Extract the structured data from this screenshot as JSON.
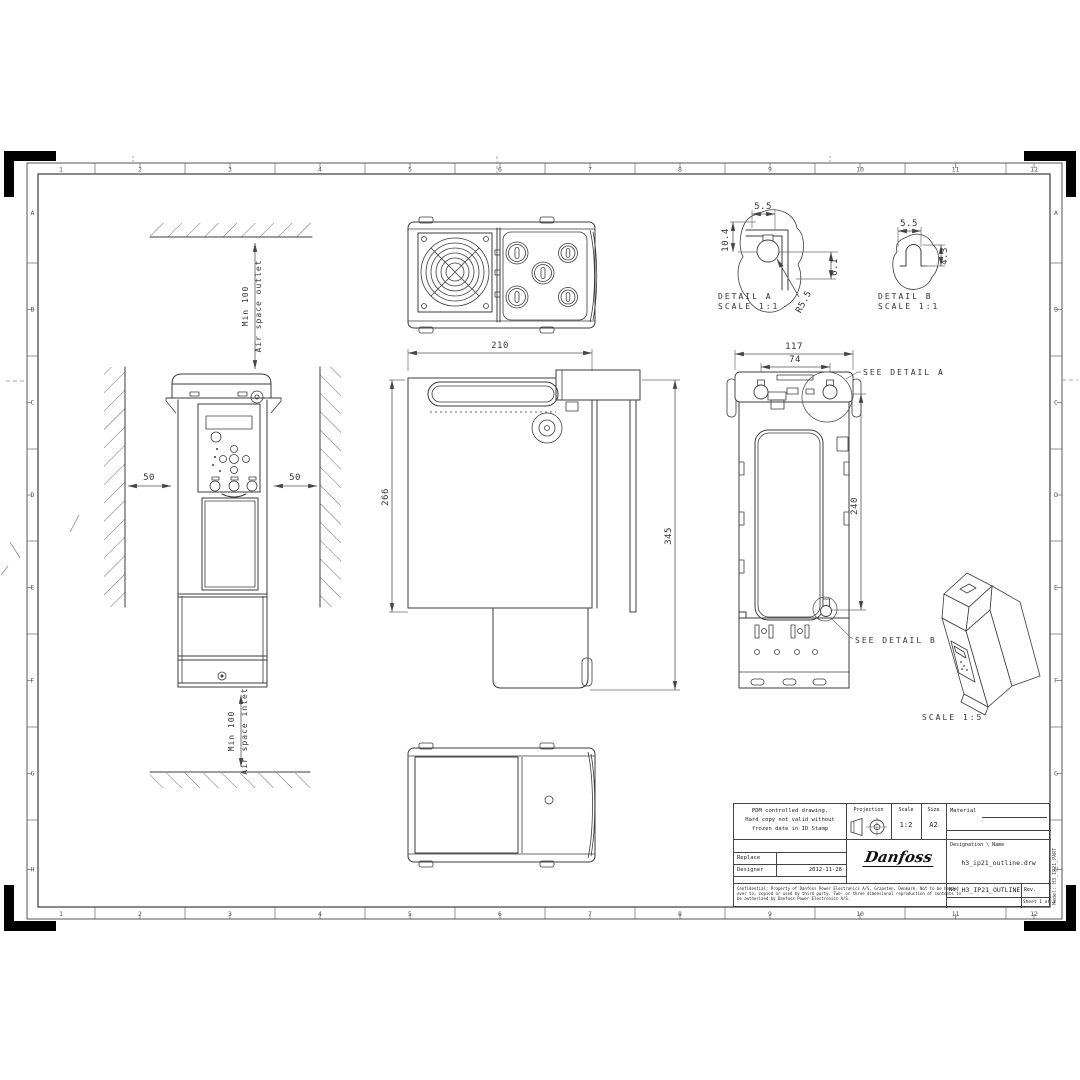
{
  "zones": {
    "columns": [
      "1",
      "2",
      "3",
      "4",
      "5",
      "6",
      "7",
      "8",
      "9",
      "10",
      "11",
      "12"
    ],
    "rows": [
      "A",
      "B",
      "C",
      "D",
      "E",
      "F",
      "G",
      "H"
    ]
  },
  "drawing": {
    "clearance": {
      "outlet_dim": "Min 100",
      "outlet_label": "Air space outlet",
      "inlet_dim": "Min 100",
      "inlet_label": "Air space inlet",
      "gap_left": "50",
      "gap_right": "50"
    },
    "side": {
      "depth": "210",
      "body_height": "266",
      "total_height": "345"
    },
    "rear": {
      "width": "117",
      "hole_pitch": "74",
      "hole_height": "240",
      "see_detail_a": "SEE DETAIL A",
      "see_detail_b": "SEE DETAIL B"
    },
    "detail_a": {
      "title": "DETAIL A",
      "scale": "SCALE 1:1",
      "dim_width": "5.5",
      "dim_height": "10.4",
      "dim_offset": "6.1",
      "dim_radius": "R5.5"
    },
    "detail_b": {
      "title": "DETAIL B",
      "scale": "SCALE 1:1",
      "dim_width": "5.5",
      "dim_height": "4.3"
    },
    "iso": {
      "scale_label": "SCALE 1:5"
    }
  },
  "title_block": {
    "pdm_note_1": "PDM controlled drawing.",
    "pdm_note_2": "Hard copy not valid without",
    "pdm_note_3": "frozen date in ID Stamp",
    "projection_label": "Projection",
    "scale_label": "Scale",
    "scale_value": "1:2",
    "size_label": "Size",
    "size_value": "A2",
    "material_label": "Material",
    "replace_label": "Replace",
    "designer_label": "Designer",
    "designer_date": "2012-11-28",
    "logo": "Danfoss",
    "designation_label": "Designation \\ Name",
    "designation_value": "h3_ip21_outline.drw",
    "confidential_1": "Confidential; Property of Danfoss Power Electronics A/S, Graasten, Denmark. Not to be handed",
    "confidential_2": "over to, copied or used by third party. Two- or three dimensional reproduction of contents to",
    "confidential_3": "be authorized by Danfoss Power Electronics A/S.",
    "no_label": "No.",
    "no_value": "H3_IP21_OUTLINE",
    "rev_label": "Rev.",
    "sheet_label": "Sheet 1 of 1",
    "model_label": "Model: H3_IP21_PART"
  }
}
